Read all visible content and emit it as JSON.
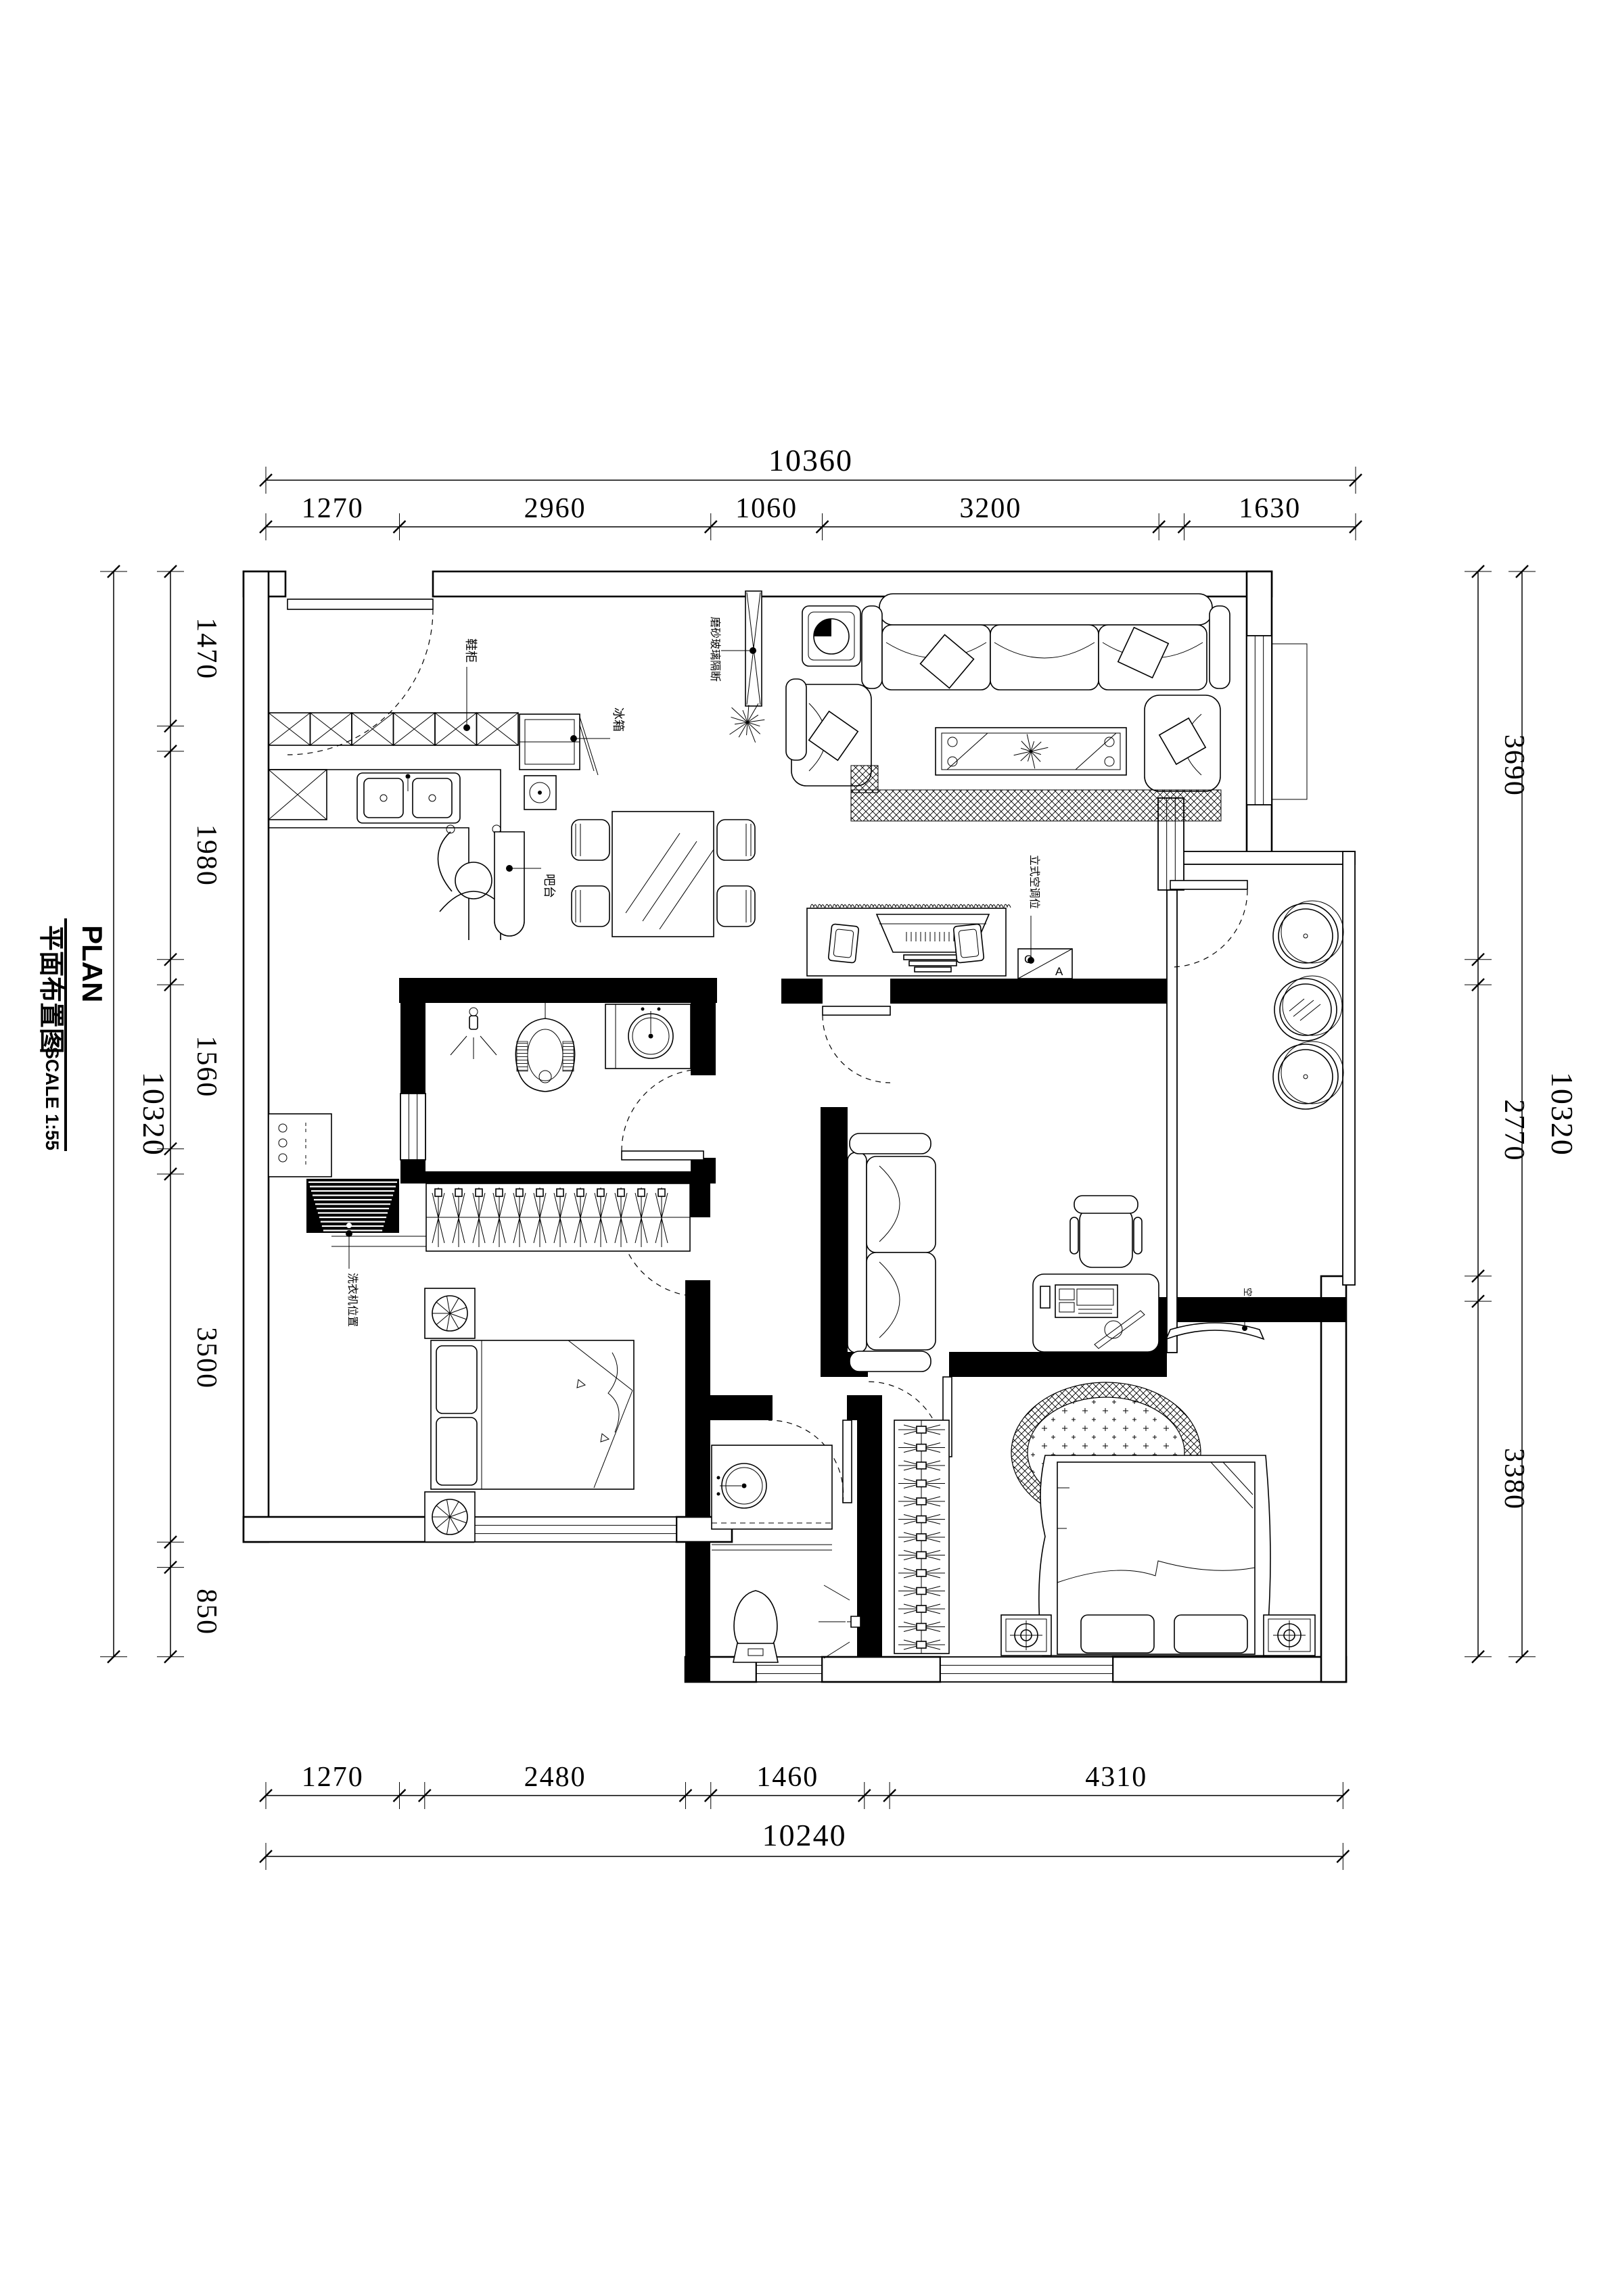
{
  "title_block": {
    "plan_en": "PLAN",
    "plan_cn": "平面布置图",
    "scale": "SCALE 1:55"
  },
  "dimensions": {
    "top": {
      "total": {
        "label": "10360",
        "mm": 10360
      },
      "segments": [
        {
          "label": "1270",
          "mm": 1270
        },
        {
          "label": "2960",
          "mm": 2960
        },
        {
          "label": "1060",
          "mm": 1060
        },
        {
          "label": "3200",
          "mm": 3200
        },
        {
          "label": "",
          "mm": 240
        },
        {
          "label": "1630",
          "mm": 1630
        }
      ]
    },
    "bottom": {
      "total": {
        "label": "10240",
        "mm": 10240
      },
      "segments": [
        {
          "label": "1270",
          "mm": 1270
        },
        {
          "label": "",
          "mm": 240
        },
        {
          "label": "2480",
          "mm": 2480
        },
        {
          "label": "",
          "mm": 240
        },
        {
          "label": "1460",
          "mm": 1460
        },
        {
          "label": "",
          "mm": 240
        },
        {
          "label": "4310",
          "mm": 4310
        }
      ]
    },
    "left": {
      "total": {
        "label": "10320",
        "mm": 10320
      },
      "segments": [
        {
          "label": "1470",
          "mm": 1470
        },
        {
          "label": "",
          "mm": 240
        },
        {
          "label": "1980",
          "mm": 1980
        },
        {
          "label": "",
          "mm": 240
        },
        {
          "label": "1560",
          "mm": 1560
        },
        {
          "label": "",
          "mm": 240
        },
        {
          "label": "3500",
          "mm": 3500
        },
        {
          "label": "",
          "mm": 240
        },
        {
          "label": "850",
          "mm": 850
        }
      ]
    },
    "right": {
      "total": {
        "label": "10320",
        "mm": 10320
      },
      "segments": [
        {
          "label": "3690",
          "mm": 3690
        },
        {
          "label": "",
          "mm": 240
        },
        {
          "label": "2770",
          "mm": 2770
        },
        {
          "label": "",
          "mm": 240
        },
        {
          "label": "3380",
          "mm": 3380
        }
      ]
    }
  },
  "plan_labels": {
    "shoe_cabinet": "鞋柜",
    "fridge": "冰箱",
    "bar_counter": "吧台",
    "partition": "磨砂玻璃隔断",
    "floor_ac": "立式空调位",
    "washer": "洗衣机位置",
    "wall_ac": "空调",
    "ac_letter_a": "A",
    "ac_letter_c": "C"
  }
}
